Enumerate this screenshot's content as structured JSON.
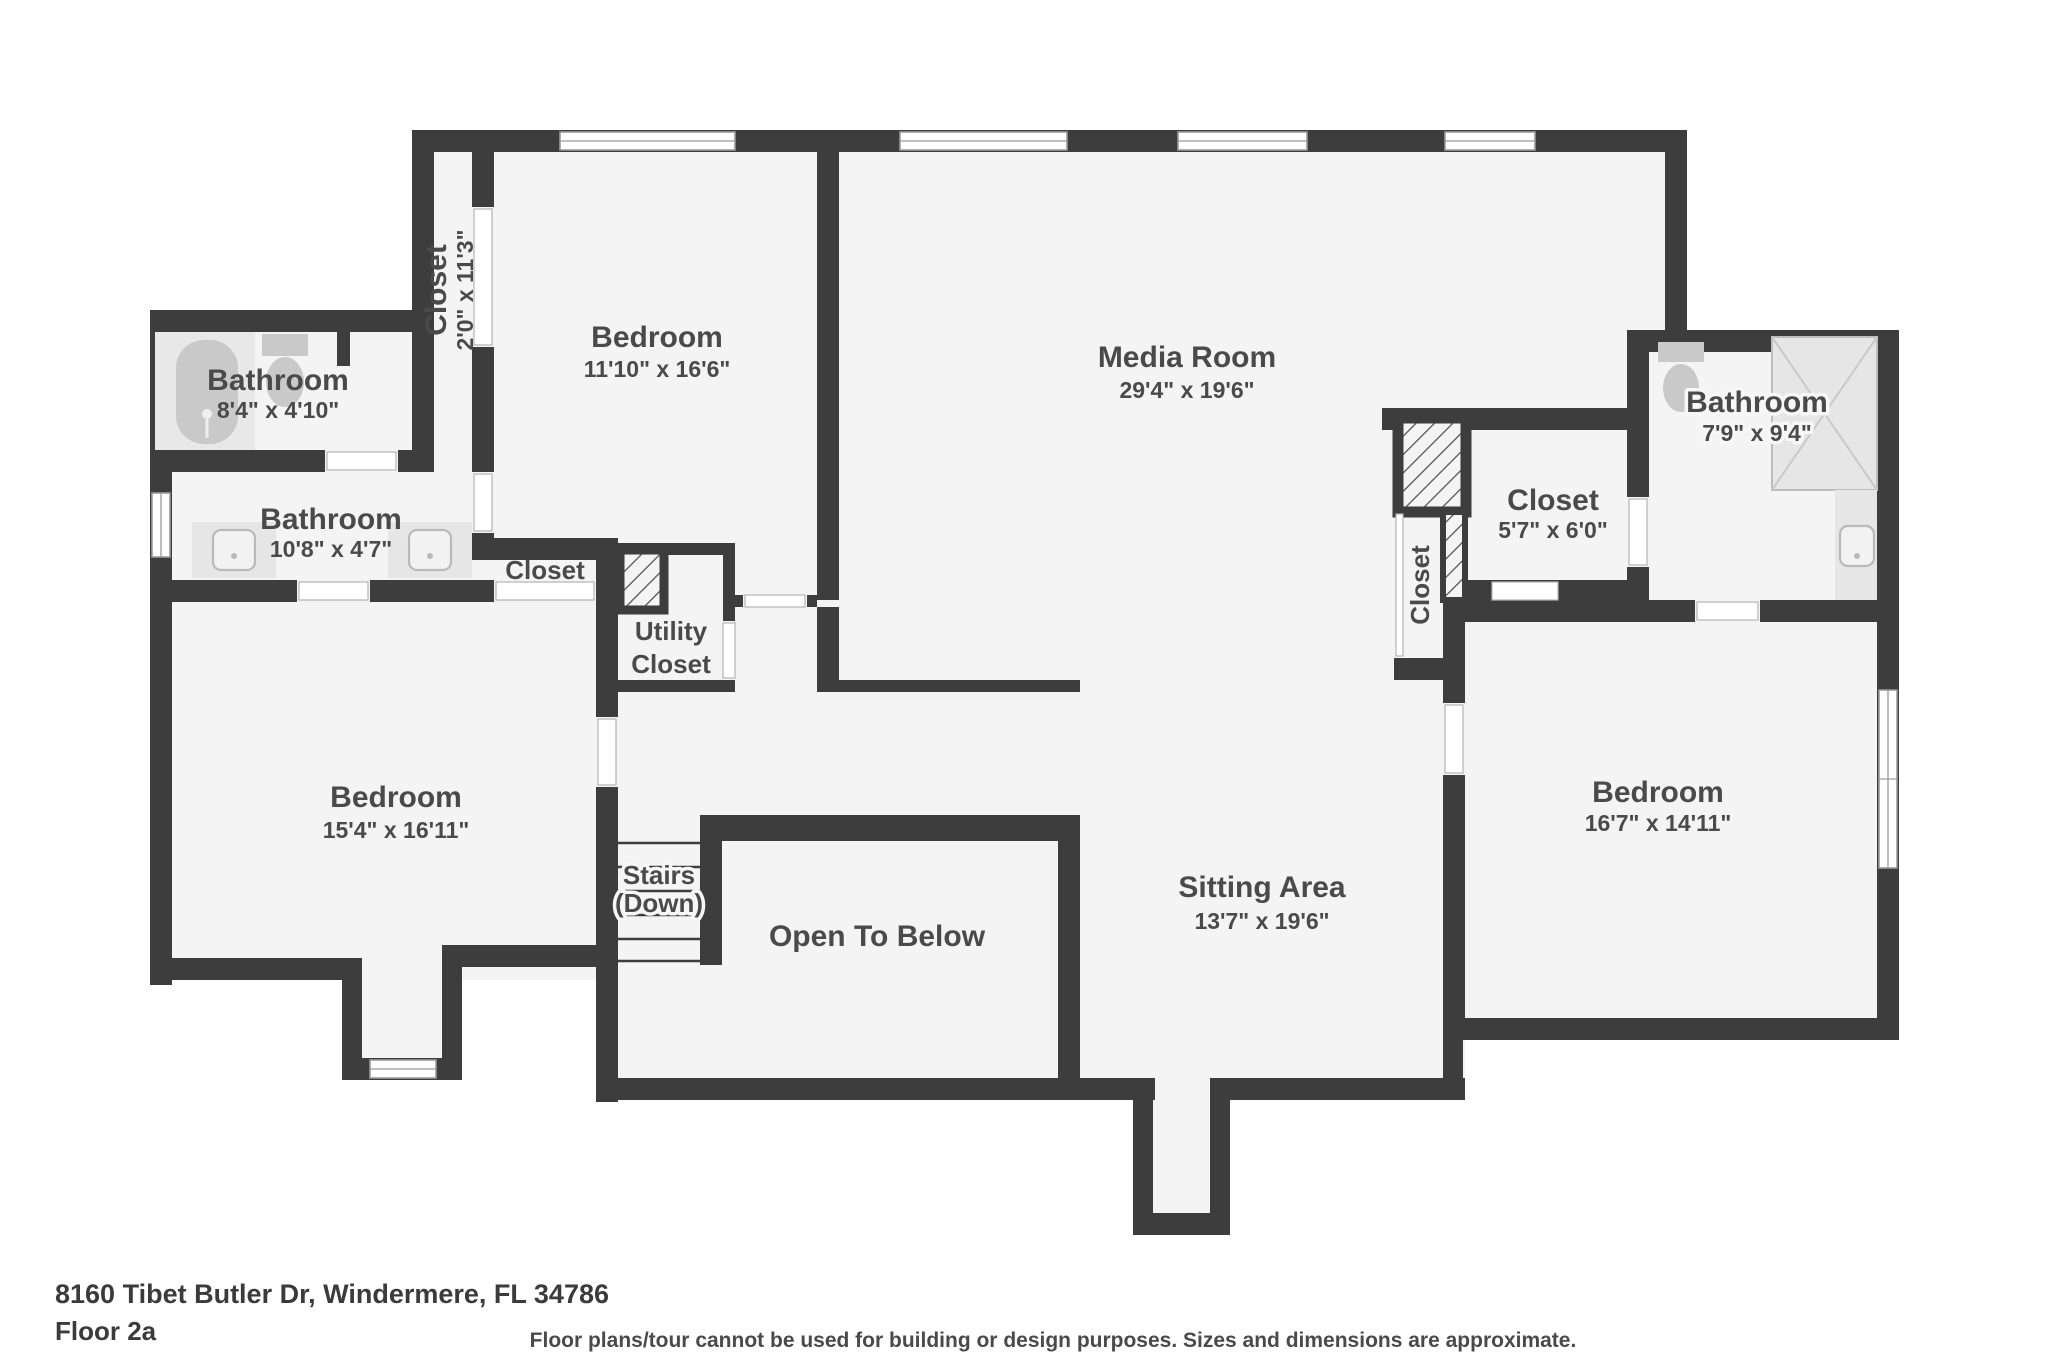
{
  "page": {
    "wall_color": "#3d3d3d",
    "floor_color": "#f4f4f4",
    "label_color": "#4a4a4a"
  },
  "footer": {
    "address": "8160 Tibet Butler Dr, Windermere, FL 34786",
    "floor_label": "Floor 2a",
    "disclaimer": "Floor plans/tour cannot be used for building or design purposes. Sizes and dimensions are approximate."
  },
  "rooms": {
    "bathroom_top_left": {
      "name": "Bathroom",
      "dims": "8'4\" x 4'10\""
    },
    "closet_tall": {
      "name": "Closet",
      "dims": "2'0\" x 11'3\""
    },
    "bedroom_top": {
      "name": "Bedroom",
      "dims": "11'10\" x 16'6\""
    },
    "media_room": {
      "name": "Media Room",
      "dims": "29'4\" x 19'6\""
    },
    "bathroom_right": {
      "name": "Bathroom",
      "dims": "7'9\" x 9'4\""
    },
    "closet_right": {
      "name": "Closet",
      "dims": "5'7\" x 6'0\""
    },
    "closet_vertical": {
      "name": "Closet"
    },
    "bathroom_left": {
      "name": "Bathroom",
      "dims": "10'8\" x 4'7\""
    },
    "closet_small": {
      "name": "Closet"
    },
    "utility_closet": {
      "lines": [
        "Utility",
        "Closet"
      ]
    },
    "bedroom_left": {
      "name": "Bedroom",
      "dims": "15'4\" x 16'11\""
    },
    "stairs": {
      "lines": [
        "Stairs",
        "(Down)"
      ]
    },
    "open_to_below": {
      "name": "Open To Below"
    },
    "sitting_area": {
      "name": "Sitting Area",
      "dims": "13'7\" x 19'6\""
    },
    "bedroom_right": {
      "name": "Bedroom",
      "dims": "16'7\" x 14'11\""
    }
  }
}
